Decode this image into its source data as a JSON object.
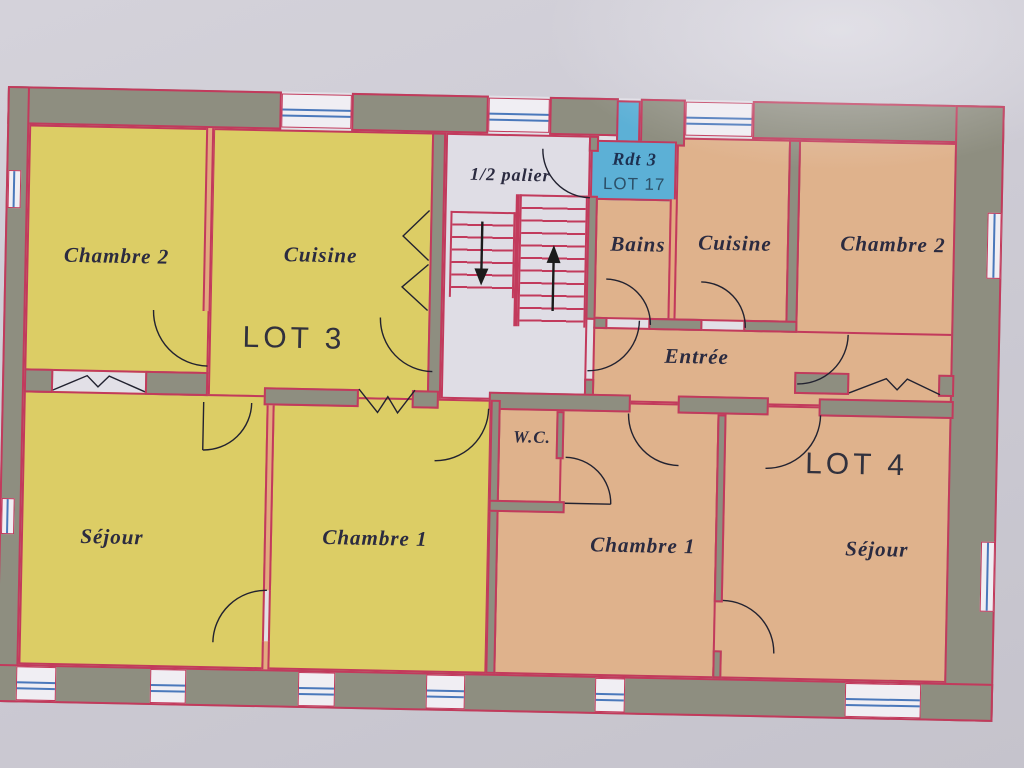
{
  "plan": {
    "lot3": {
      "label": "LOT 3",
      "chambre2": "Chambre 2",
      "cuisine": "Cuisine",
      "sejour": "Séjour",
      "chambre1": "Chambre 1"
    },
    "lot4": {
      "label": "LOT 4",
      "bains": "Bains",
      "cuisine": "Cuisine",
      "chambre2": "Chambre 2",
      "entree": "Entrée",
      "wc": "W.C.",
      "chambre1": "Chambre 1",
      "sejour": "Séjour"
    },
    "landing": {
      "half_landing": "1/2 palier"
    },
    "annex": {
      "title": "Rdt 3",
      "lot": "LOT 17"
    },
    "stairs": {
      "down_arrow": "↓",
      "up_arrow": "↑"
    },
    "colors": {
      "lot3_fill": "#dccd65",
      "lot4_fill": "#dfb28c",
      "annex_fill": "#5cb0d6",
      "wall_fill": "#8e8e80",
      "plan_line": "#c23a5c",
      "window_line": "#4a78bb"
    }
  }
}
